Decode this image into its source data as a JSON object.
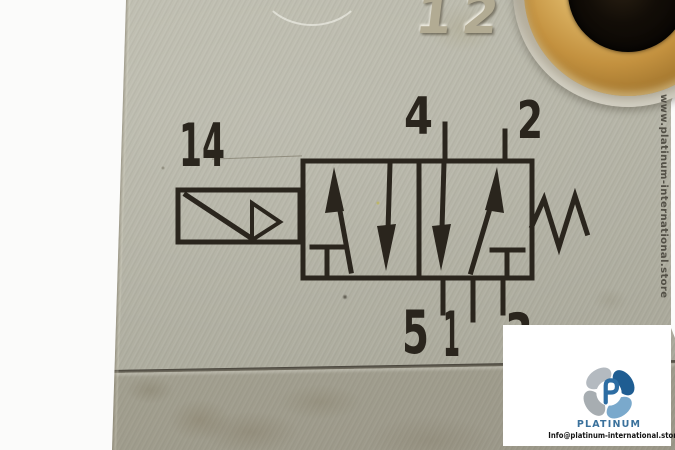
{
  "schematic": {
    "pilot_port_label": "14",
    "top_port_labels": [
      "4",
      "2"
    ],
    "bottom_port_labels": [
      "5",
      "1",
      "3"
    ],
    "embossed_marking": "12"
  },
  "watermark": {
    "text": "www.platinum-international.store"
  },
  "logo": {
    "brand": "PLATINUM",
    "email": "Info@platinum-international.store"
  },
  "colors": {
    "ink": "#2a251d",
    "body_gray": "#b2b1a3",
    "brass": "#c3913f",
    "logo_blue": "#2d6da3",
    "white_backdrop": "#fbfbfa"
  }
}
